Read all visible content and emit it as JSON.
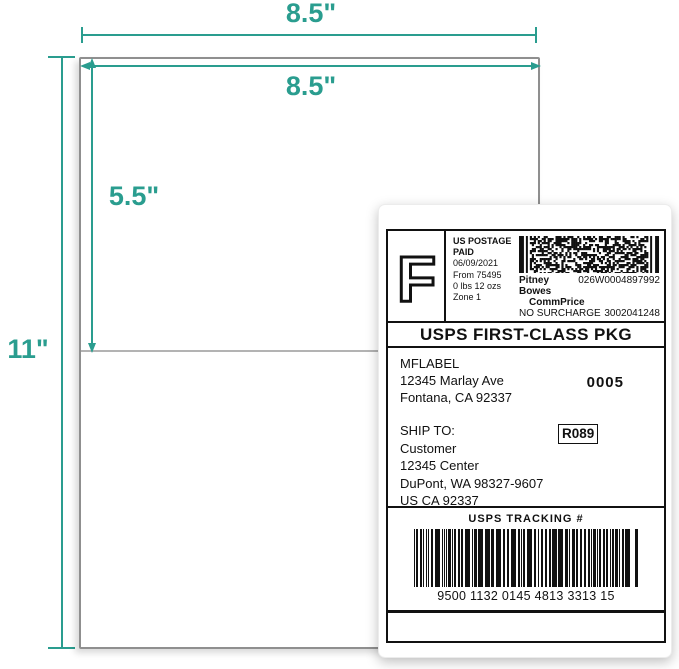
{
  "accent_color": "#2a9d8f",
  "diagram": {
    "sheet_width_label": "8.5\"",
    "sheet_height_label": "11\"",
    "label_width_label": "8.5\"",
    "label_height_label": "5.5\""
  },
  "shipping_label": {
    "postage": {
      "letter": "F",
      "line1": "US POSTAGE",
      "line2": "PAID",
      "date": "06/09/2021",
      "from": "From 75495",
      "weight": "0 lbs 12 ozs",
      "zone": "Zone 1",
      "carrier": "Pitney Bowes",
      "meter_number": "026W0004897992",
      "rate_name": "CommPrice",
      "surcharge": "NO SURCHARGE",
      "serial": "3002041248"
    },
    "service": "USPS FIRST-CLASS PKG",
    "sender": {
      "name": "MFLABEL",
      "street": "12345 Marlay Ave",
      "city": "Fontana, CA 92337"
    },
    "batch_number": "0005",
    "ship_to_label": "SHIP TO:",
    "recipient": {
      "name": "Customer",
      "street": "12345 Center",
      "city": "DuPont, WA 98327-9607",
      "country": "US CA 92337"
    },
    "route_code": "R089",
    "tracking": {
      "title": "USPS TRACKING #",
      "number": "9500 1132 0145 4813 3313 15"
    }
  }
}
